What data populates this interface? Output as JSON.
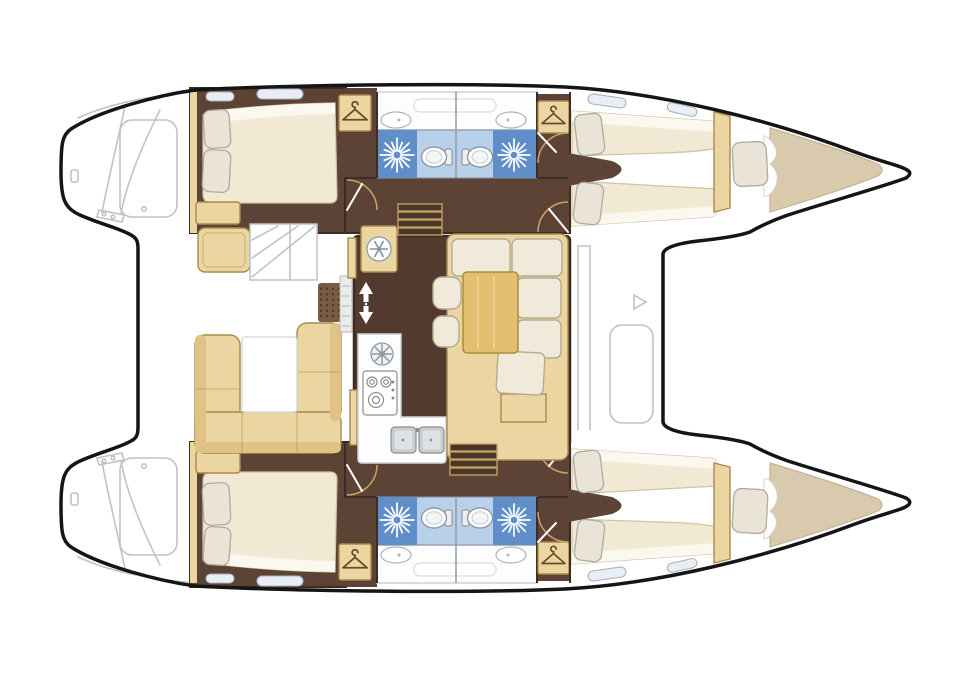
{
  "diagram": {
    "type": "boat-floor-plan",
    "subject": "catamaran sailing yacht interior layout, top view, bows to the right",
    "visible_text": "none"
  },
  "palette": {
    "outline": "#151515",
    "detail_gray": "#bdc3c9",
    "floor_hull": "#5d4336",
    "floor_salon": "#523a2f",
    "wall_brown": "#3c2c23",
    "tan": "#ebd5a0",
    "tan_border": "#a98a4e",
    "tan_backrest": "#dfc284",
    "amber": "#e3bf72",
    "amber_border": "#b08c3e",
    "cream": "#f0eadb",
    "cream_border": "#b6ab8f",
    "mattress": "#f1e9d3",
    "mattress_border": "#cfc3a5",
    "sheet_white": "#fbf8ef",
    "pillow": "#eae4d8",
    "pillow_border": "#b1ab9e",
    "bow_beige": "#d9c9ad",
    "bow_border": "#c3b295",
    "shower_blue": "#5f8ec9",
    "bath_blue": "#b9d0ea",
    "bath_border": "#8f9aa8",
    "counter": "#fdfdfd",
    "counter_border": "#cfd2d5",
    "steel": "#c9cdd1",
    "steel_border": "#8a9095",
    "steel_inner": "#dfe2e5",
    "glass": "#e8eef4",
    "glass_border": "#a9b3bd",
    "arc_tan": "#c9a464",
    "grate": "#7a5a44",
    "grate_dot": "#4c362a",
    "step_brown": "#4a352b",
    "icon_gray": "#8e9aa6",
    "icon_brown": "#6b4a2f",
    "icon_blue": "#7f93a8",
    "tank_fill": "#eceef0",
    "toilet_inner": "#f2f4f5",
    "fan_fill": "#f0f1f2",
    "louver": "#ebebe9",
    "louver_border": "#b7b7b4",
    "shelf_border": "#d8dbde",
    "table_grain": "#eed9a4",
    "curtain_border": "#d9d2c4",
    "white_table_border": "#dcdcdc",
    "white": "#ffffff"
  },
  "structure": {
    "hulls": [
      {
        "name": "starboard-hull",
        "position": "top",
        "rooms": [
          "aft double cabin",
          "wardrobe",
          "head with shower",
          "head with shower",
          "forward double cabin",
          "bow berth",
          "bow locker"
        ]
      },
      {
        "name": "port-hull",
        "position": "bottom",
        "rooms": [
          "aft double cabin",
          "wardrobe",
          "head with shower",
          "head with shower",
          "forward double cabin",
          "bow berth",
          "bow locker"
        ]
      }
    ],
    "bridge_deck": {
      "cockpit": [
        "aft bench seat",
        "u-shaped settee",
        "cockpit table",
        "helm steps",
        "deck grate"
      ],
      "salon": [
        "refrigerator",
        "companionway steps starboard",
        "companionway steps port",
        "galley with stove and double sink",
        "extractor vent",
        "dinette table",
        "l-shaped settee",
        "two ottomans"
      ],
      "foredeck": [
        "deck locker outline",
        "coachroof lines"
      ]
    }
  },
  "icons": [
    {
      "name": "hanger-icon",
      "meaning": "wardrobe / hanging locker"
    },
    {
      "name": "shower-starburst-icon",
      "meaning": "shower head"
    },
    {
      "name": "toilet-icon",
      "meaning": "marine toilet"
    },
    {
      "name": "snowflake-icon",
      "meaning": "refrigerator"
    },
    {
      "name": "fan-vent-icon",
      "meaning": "galley extractor vent"
    },
    {
      "name": "stove-icon",
      "meaning": "galley stove burners"
    },
    {
      "name": "sink-icon",
      "meaning": "double galley sink"
    },
    {
      "name": "arrow-up-icon",
      "meaning": "companionway up"
    },
    {
      "name": "arrow-down-icon",
      "meaning": "companionway down"
    }
  ]
}
